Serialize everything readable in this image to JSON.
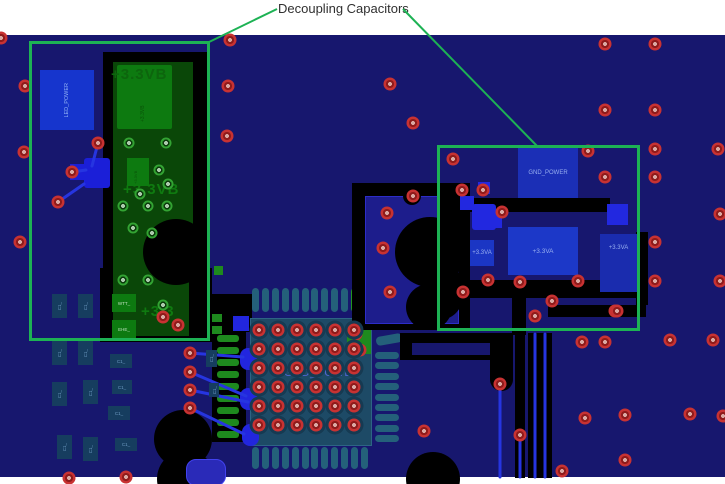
{
  "annotation": {
    "title": "Decoupling Capacitors"
  },
  "colors": {
    "highlight_green": "#1db254",
    "board_navy": "#17176e",
    "via_red": "#c83232",
    "pour_green": "#0a4708",
    "pad_green": "#0d7a10",
    "pad_blue": "#2228e0",
    "panel_teal": "#1d4a66"
  },
  "nets": {
    "v33vb": "+3.3VB",
    "v33vb_partial": "+3.3",
    "gnd_power": "GND_POWER",
    "led_power": "LED_POWER",
    "v33va": "+3.3VA",
    "pad_wtt": "WTT_",
    "pad_ehe": "EHE_",
    "cap_vert": "+3.3VB",
    "ref_generic": "C1_"
  },
  "bga": {
    "label": "GND_POWER",
    "cols": [
      259,
      278,
      297,
      316,
      335,
      354
    ],
    "rows": [
      330,
      349,
      368,
      387,
      406,
      425
    ]
  },
  "red_vias": [
    [
      1,
      38
    ],
    [
      230,
      40
    ],
    [
      228,
      86
    ],
    [
      227,
      136
    ],
    [
      25,
      86
    ],
    [
      24,
      152
    ],
    [
      20,
      242
    ],
    [
      98,
      143
    ],
    [
      72,
      172
    ],
    [
      58,
      202
    ],
    [
      163,
      317
    ],
    [
      178,
      325
    ],
    [
      390,
      84
    ],
    [
      413,
      123
    ],
    [
      413,
      196
    ],
    [
      387,
      213
    ],
    [
      383,
      248
    ],
    [
      390,
      292
    ],
    [
      463,
      292
    ],
    [
      190,
      353
    ],
    [
      190,
      372
    ],
    [
      190,
      390
    ],
    [
      190,
      408
    ],
    [
      356,
      334
    ],
    [
      360,
      350
    ],
    [
      453,
      159
    ],
    [
      462,
      190
    ],
    [
      483,
      190
    ],
    [
      502,
      212
    ],
    [
      588,
      151
    ],
    [
      605,
      44
    ],
    [
      655,
      44
    ],
    [
      605,
      110
    ],
    [
      655,
      110
    ],
    [
      655,
      149
    ],
    [
      718,
      149
    ],
    [
      605,
      177
    ],
    [
      655,
      177
    ],
    [
      720,
      214
    ],
    [
      655,
      242
    ],
    [
      655,
      281
    ],
    [
      720,
      281
    ],
    [
      615,
      311
    ],
    [
      488,
      280
    ],
    [
      520,
      282
    ],
    [
      578,
      281
    ],
    [
      552,
      301
    ],
    [
      535,
      316
    ],
    [
      617,
      311
    ],
    [
      670,
      340
    ],
    [
      713,
      340
    ],
    [
      582,
      342
    ],
    [
      605,
      342
    ],
    [
      500,
      384
    ],
    [
      520,
      435
    ],
    [
      424,
      431
    ],
    [
      585,
      418
    ],
    [
      625,
      415
    ],
    [
      690,
      414
    ],
    [
      723,
      416
    ],
    [
      625,
      460
    ],
    [
      562,
      471
    ],
    [
      69,
      478
    ],
    [
      126,
      477
    ]
  ],
  "green_vias": [
    [
      129,
      143
    ],
    [
      166,
      143
    ],
    [
      159,
      170
    ],
    [
      168,
      184
    ],
    [
      140,
      194
    ],
    [
      123,
      206
    ],
    [
      148,
      206
    ],
    [
      167,
      206
    ],
    [
      133,
      228
    ],
    [
      152,
      233
    ],
    [
      123,
      280
    ],
    [
      148,
      280
    ],
    [
      163,
      305
    ]
  ],
  "capsules": {
    "top": {
      "x0": 252,
      "step": 9.9,
      "count": 12,
      "y": 288,
      "w": 7,
      "h": 24,
      "green_index": 10
    },
    "bottom": {
      "x0": 252,
      "step": 9.9,
      "count": 12,
      "y": 447,
      "w": 7,
      "h": 22
    },
    "right": {
      "y0": 352,
      "step": 10.4,
      "count": 9,
      "x": 375,
      "w": 24,
      "h": 7
    },
    "left_bars": {
      "y0": 335,
      "step": 12,
      "count": 9,
      "x": 217,
      "w": 22,
      "h": 7
    }
  },
  "ref_labels": [
    [
      52,
      294,
      15,
      24,
      "v"
    ],
    [
      78,
      294,
      15,
      24,
      "v"
    ],
    [
      52,
      341,
      15,
      24,
      "v"
    ],
    [
      78,
      341,
      15,
      24,
      "v"
    ],
    [
      52,
      382,
      15,
      24,
      "v"
    ],
    [
      83,
      380,
      15,
      24,
      "v"
    ],
    [
      110,
      354,
      22,
      14,
      "h"
    ],
    [
      112,
      380,
      20,
      14,
      "h"
    ],
    [
      108,
      406,
      22,
      14,
      "h"
    ],
    [
      57,
      435,
      15,
      24,
      "v"
    ],
    [
      83,
      437,
      15,
      24,
      "v"
    ],
    [
      115,
      438,
      22,
      13,
      "h"
    ],
    [
      206,
      350,
      11,
      17,
      "v"
    ],
    [
      209,
      383,
      10,
      14,
      "v"
    ]
  ]
}
